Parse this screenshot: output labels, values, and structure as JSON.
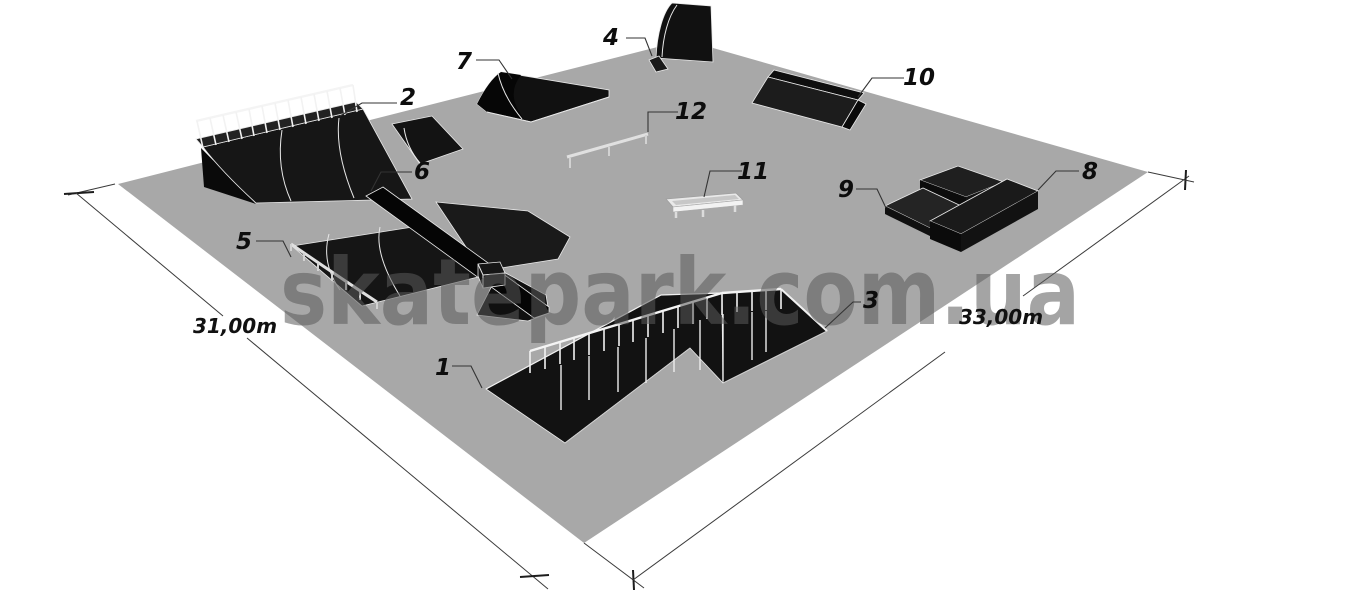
{
  "watermark": {
    "text": "skatepark.com.ua"
  },
  "dimensions": {
    "left": "31,00m",
    "right": "33,00m"
  },
  "colors": {
    "ground": "#a8a8a8",
    "obstacle": "#141414",
    "watermark": "#5a5a5a"
  },
  "obstacles": [
    {
      "num": "1",
      "type": "long bank with railing - low end"
    },
    {
      "num": "2",
      "type": "bank ramp with safety railing"
    },
    {
      "num": "3",
      "type": "bank with railing - high end"
    },
    {
      "num": "4",
      "type": "tall quarter pipe"
    },
    {
      "num": "5",
      "type": "handrail on bank edge"
    },
    {
      "num": "6",
      "type": "funbox with crossing grind beam"
    },
    {
      "num": "7",
      "type": "kicker ramp"
    },
    {
      "num": "8",
      "type": "long grind box"
    },
    {
      "num": "9",
      "type": "stacked manual pads"
    },
    {
      "num": "10",
      "type": "wedge bank ramp"
    },
    {
      "num": "11",
      "type": "low grind ledge"
    },
    {
      "num": "12",
      "type": "flat grind rail"
    }
  ]
}
